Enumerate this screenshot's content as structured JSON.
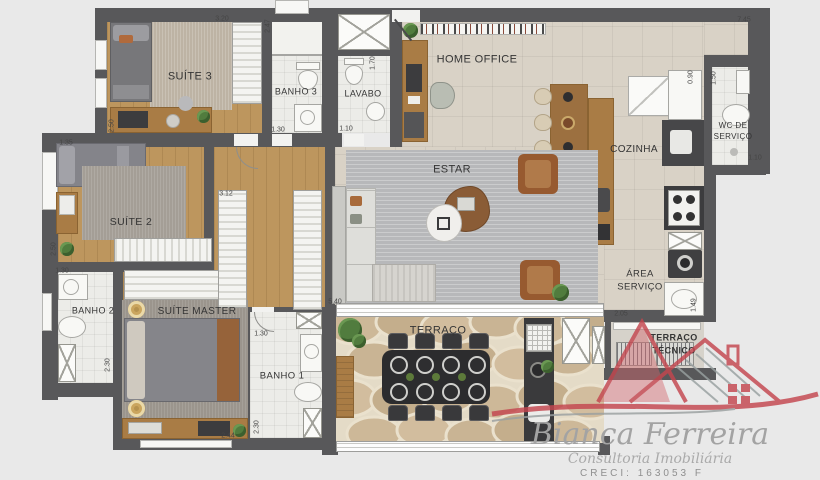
{
  "plan": {
    "rooms": {
      "suite3": {
        "label": "SUÍTE 3"
      },
      "banho3": {
        "label": "BANHO 3"
      },
      "lavabo": {
        "label": "LAVABO"
      },
      "home_office": {
        "label": "HOME OFFICE"
      },
      "cozinha": {
        "label": "COZINHA"
      },
      "wc_servico": {
        "label_line1": "WC DE",
        "label_line2": "SERVIÇO"
      },
      "estar": {
        "label": "ESTAR"
      },
      "suite2": {
        "label": "SUÍTE 2"
      },
      "banho2": {
        "label": "BANHO 2"
      },
      "suite_master": {
        "label": "SUÍTE MASTER"
      },
      "banho1": {
        "label": "BANHO 1"
      },
      "area_servico": {
        "label_line1": "ÁREA",
        "label_line2": "SERVIÇO"
      },
      "terraco": {
        "label": "TERRAÇO"
      },
      "terraco_tecnico": {
        "label_line1": "TERRAÇO",
        "label_line2": "TÉCNICO"
      }
    },
    "measurements": [
      {
        "t": "3.20",
        "x": 222,
        "y": 19,
        "v": false
      },
      {
        "t": "2.50",
        "x": 112,
        "y": 126,
        "v": true
      },
      {
        "t": "2.47",
        "x": 268,
        "y": 26,
        "v": true
      },
      {
        "t": "1.30",
        "x": 278,
        "y": 130,
        "v": false
      },
      {
        "t": "1.70",
        "x": 373,
        "y": 63,
        "v": true
      },
      {
        "t": "1.10",
        "x": 346,
        "y": 129,
        "v": false
      },
      {
        "t": "7.45",
        "x": 744,
        "y": 20,
        "v": false
      },
      {
        "t": "0.90",
        "x": 691,
        "y": 77,
        "v": true
      },
      {
        "t": "1.50",
        "x": 714,
        "y": 78,
        "v": true
      },
      {
        "t": "1.10",
        "x": 755,
        "y": 158,
        "v": false
      },
      {
        "t": "1.35",
        "x": 66,
        "y": 143,
        "v": false
      },
      {
        "t": "2.50",
        "x": 54,
        "y": 249,
        "v": true
      },
      {
        "t": "1.30",
        "x": 62,
        "y": 271,
        "v": false
      },
      {
        "t": "2.30",
        "x": 108,
        "y": 365,
        "v": true
      },
      {
        "t": "3.12",
        "x": 226,
        "y": 194,
        "v": false
      },
      {
        "t": "1.30",
        "x": 261,
        "y": 334,
        "v": false
      },
      {
        "t": "2.30",
        "x": 257,
        "y": 427,
        "v": true
      },
      {
        "t": "5.40",
        "x": 335,
        "y": 302,
        "v": false
      },
      {
        "t": "2.05",
        "x": 621,
        "y": 314,
        "v": false
      },
      {
        "t": "1.49",
        "x": 694,
        "y": 305,
        "v": true
      },
      {
        "t": "2.44",
        "x": 228,
        "y": 436,
        "v": false
      }
    ]
  },
  "logo": {
    "name": "Bianca Ferreira",
    "tagline": "Consultoria Imobiliária",
    "creci": "CRECI: 163053 F"
  },
  "palette": {
    "background": "#e9e9e9",
    "wall": "#58585a",
    "wood_floor": "#bd965e",
    "tile_floor": "#d9d2c6",
    "bath_tile": "#ecece8",
    "estar_rug": "#b7b8ba",
    "terrace_stone": "#c9b59c",
    "logo_red": "#c4464f",
    "logo_gray": "#9d9d9d"
  }
}
